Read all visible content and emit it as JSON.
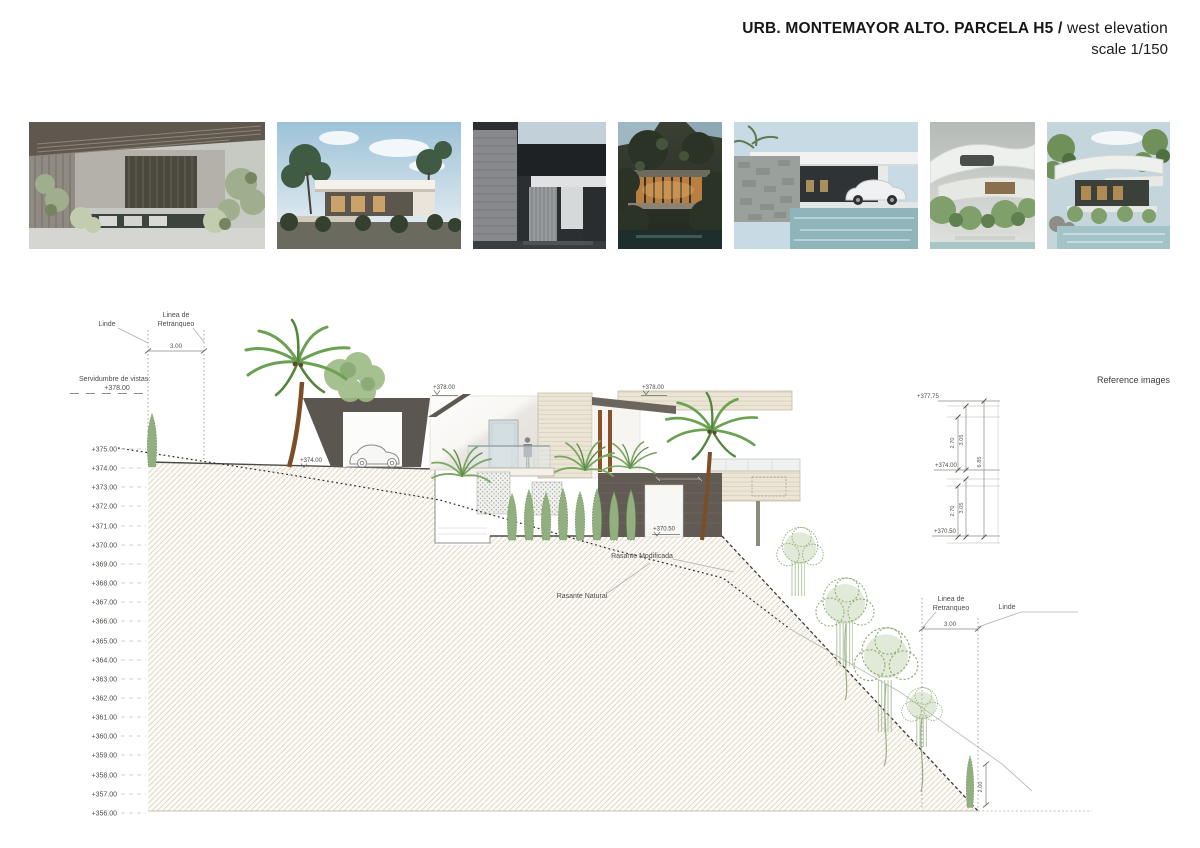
{
  "header": {
    "title_bold": "URB. MONTEMAYOR ALTO. PARCELA H5 /",
    "title_regular": "west elevation",
    "scale": "scale 1/150"
  },
  "reference_strip": {
    "caption": "Reference images",
    "images": [
      {
        "name": "courtyard-pergola-pool"
      },
      {
        "name": "white-villa-palms-sky"
      },
      {
        "name": "dark-entry-stone-wall"
      },
      {
        "name": "wood-house-forest-night"
      },
      {
        "name": "stone-wall-pool-white-car"
      },
      {
        "name": "curved-white-villa-garden"
      },
      {
        "name": "curved-canopy-pool-trees"
      }
    ]
  },
  "drawing": {
    "left_scale": {
      "levels": [
        "+375.00",
        "+374.00",
        "+373.00",
        "+372.00",
        "+371.00",
        "+370.00",
        "+369.00",
        "+368.00",
        "+367.00",
        "+366.00",
        "+365.00",
        "+364.00",
        "+363.00",
        "+362.00",
        "+361.00",
        "+360.00",
        "+359.00",
        "+358.00",
        "+357.00",
        "+356.00"
      ]
    },
    "servidumbre": {
      "label": "Servidumbre de vistas:",
      "value": "+378.00"
    },
    "boundaries_left": {
      "linde": "Linde",
      "retranqueo1": "Linea de",
      "retranqueo2": "Retranqueo",
      "dim": "3.00"
    },
    "boundaries_right": {
      "linde": "Linde",
      "retranqueo1": "Linea de",
      "retranqueo2": "Retranqueo",
      "dim": "3.00",
      "fence_height": "2.00"
    },
    "building": {
      "roof_left": "+378.00",
      "roof_right": "+378.00",
      "garage_level": "+374.00",
      "lower_level": "+370.50"
    },
    "grades": {
      "modified": "Rasante Modificada",
      "natural": "Rasante Natural"
    },
    "dims": {
      "top_level": "+377.75",
      "mid_level": "+374.00",
      "bottom_level": "+370.50",
      "clear_upper": "2.70",
      "total_upper": "3.05",
      "clear_lower": "2.70",
      "total_lower": "3.05",
      "overall": "6.85"
    }
  }
}
